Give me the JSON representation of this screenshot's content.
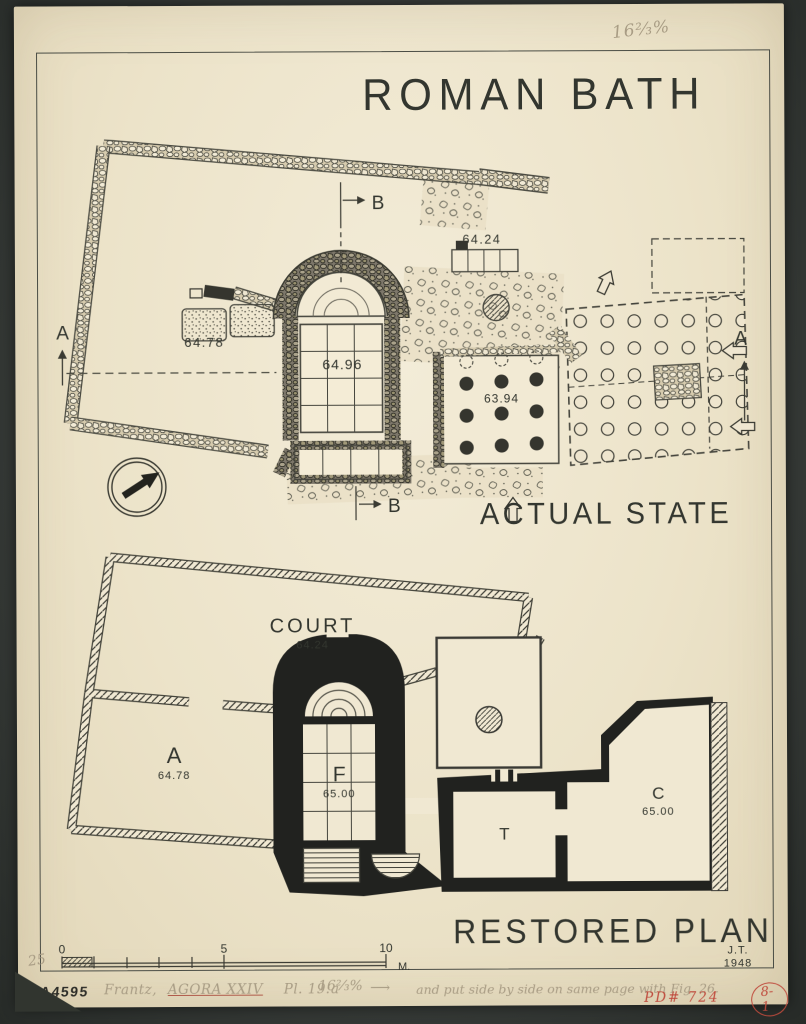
{
  "colors": {
    "mount": "#3a3e3b",
    "paper": "#ece3c9",
    "ink": "#33362f",
    "pencil": "#a89c84",
    "red": "#bf4a3c"
  },
  "header": {
    "title": "ROMAN BATH",
    "pencil_scale_note": "16⅔%"
  },
  "actual_state": {
    "caption": "ACTUAL STATE",
    "elevations": {
      "court": "64.24",
      "bases": "64.78",
      "hall": "64.96",
      "hypocaust": "63.94"
    },
    "sections": {
      "a": "A",
      "b": "B"
    }
  },
  "restored_plan": {
    "caption": "RESTORED PLAN",
    "rooms": [
      {
        "label": "COURT",
        "elevation": "64.24"
      },
      {
        "label": "A",
        "elevation": "64.78"
      },
      {
        "label": "F",
        "elevation": "65.00"
      },
      {
        "label": "T"
      },
      {
        "label": "C",
        "elevation": "65.00"
      }
    ],
    "credit": {
      "initials": "J.T.",
      "year": "1948"
    }
  },
  "scale_bar": {
    "tick_0": "0",
    "tick_5": "5",
    "tick_10": "10",
    "unit": "M."
  },
  "margin_notes": {
    "page_number": "25",
    "inventory_stamp": "A4595",
    "reference_author": "Frantz,",
    "reference_work": "AGORA XXIV",
    "reference_plate": "Pl. 19:a",
    "reference_scale": "16⅔%",
    "arrow_mark": "⟶",
    "layout_instruction": "and put side by side on same page with Fig. 26.",
    "drawing_number": "PD# 724",
    "plate_stamp": "8-1"
  }
}
